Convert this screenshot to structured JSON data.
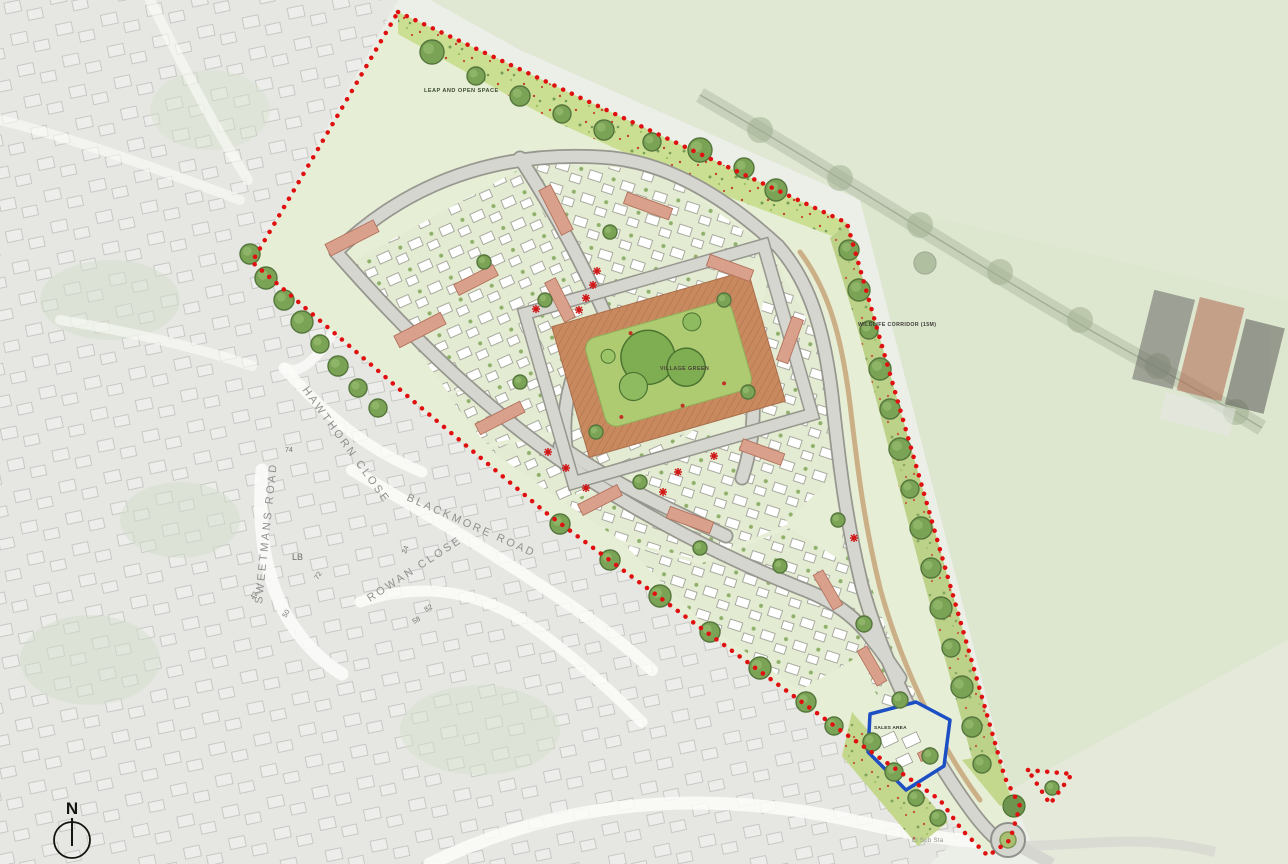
{
  "labels": {
    "leap_open_space": "LEAP AND OPEN SPACE",
    "wildlife_corridor": "WILDLIFE CORRIDOR (15M)",
    "village_green": "VILLAGE GREEN",
    "sales_area": "SALES AREA",
    "el_sub_sta": "El Sub Sta",
    "north": "N"
  },
  "existing_roads": {
    "hawthorn_close": "HAWTHORN CLOSE",
    "blackmore_road": "BLACKMORE ROAD",
    "sweetmans_road": "SWEETMANS ROAD",
    "rowan_close": "ROWAN CLOSE"
  },
  "os_plot_refs": [
    "LB",
    "74",
    "24",
    "72",
    "82",
    "58",
    "50",
    "42"
  ],
  "colors": {
    "site_boundary_red": "#E01010",
    "sales_parcel_blue": "#1D4FC4",
    "open_space_green": "#CADF92",
    "wildlife_corridor_green": "#BDD289",
    "village_green_paving": "#C9895F",
    "lawn_green": "#AECB72",
    "tree_green": "#7BA356",
    "road_grey": "#D6D6D1",
    "terrace_roof_salmon": "#D9A18C",
    "house_white": "#FFFFFF",
    "field_green": "#E0E8D4",
    "marker_red": "#D01818"
  }
}
